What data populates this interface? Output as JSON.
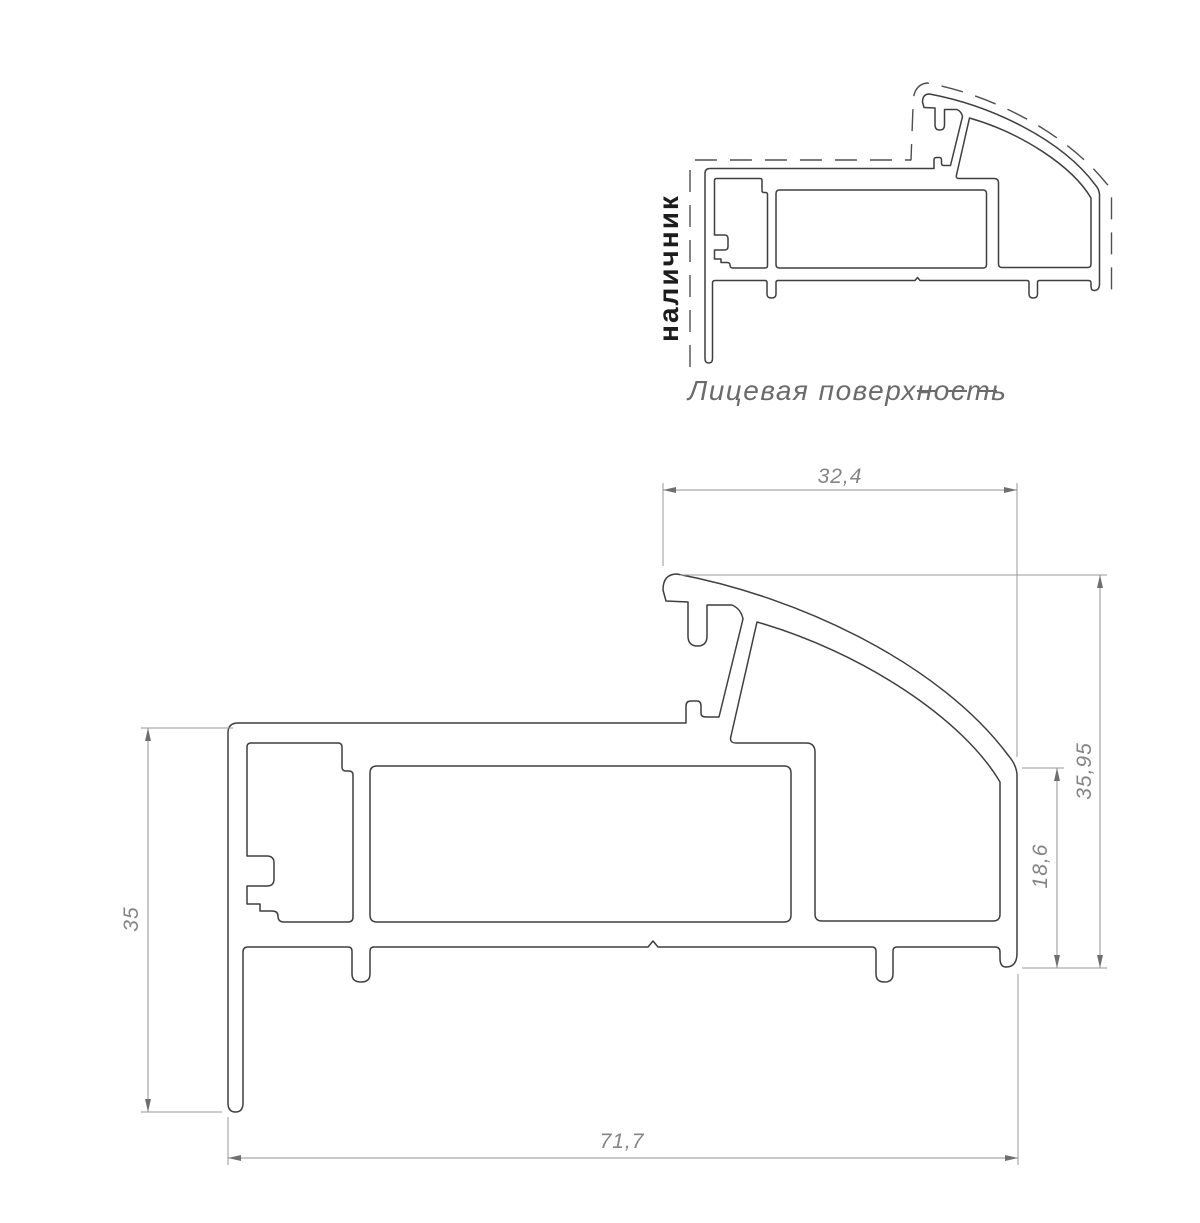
{
  "page": {
    "background": "#ffffff"
  },
  "colors": {
    "profile_outline": "#3f3f3f",
    "face_surface_dashed": "#4f4f4f",
    "dimension_lines": "#909090",
    "dimension_text": "#858585",
    "casing_label_text": "#1c1c1c",
    "legend_text": "#6b6b6b"
  },
  "overview_drawing": {
    "casing_label": "наличник",
    "legend_label": "Лицевая поверхность"
  },
  "main_drawing": {
    "dimensions": {
      "top_width": "32,4",
      "overall_height": "35,95",
      "right_wall_height": "18,6",
      "left_height": "35",
      "overall_width": "71,7"
    }
  }
}
